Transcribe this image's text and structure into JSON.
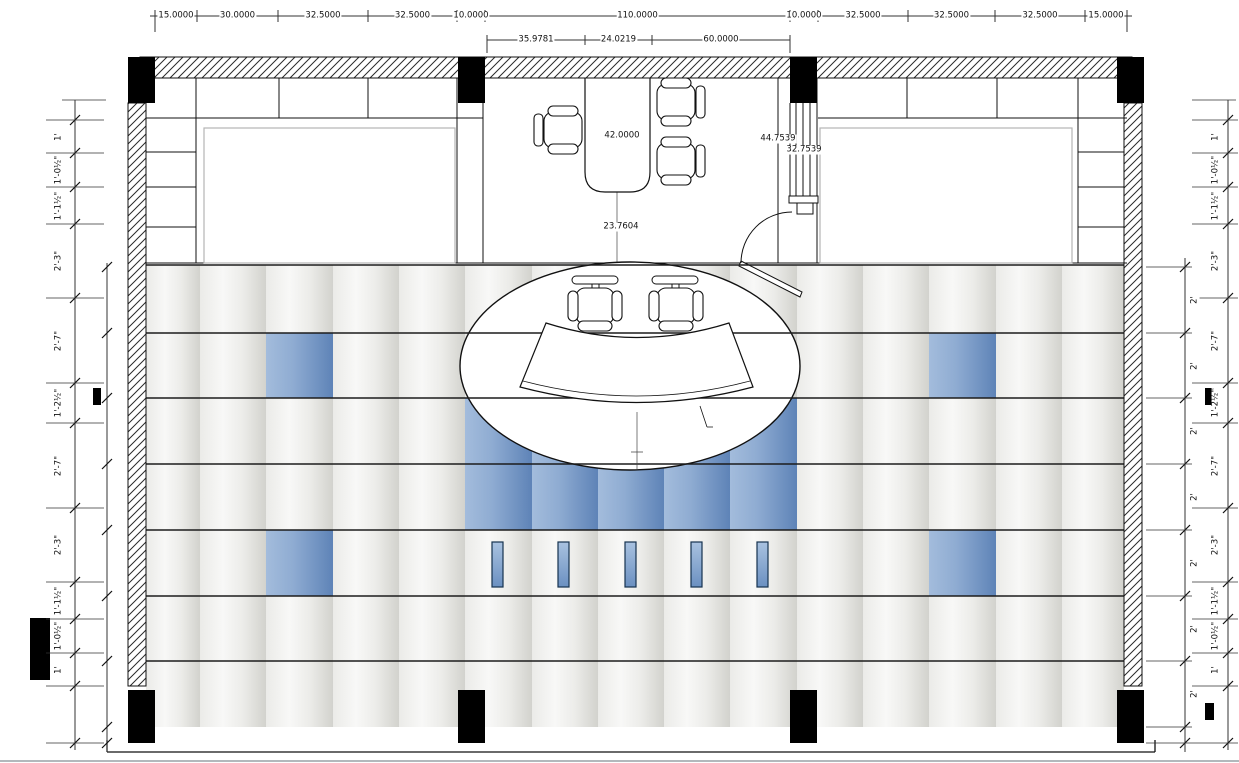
{
  "drawing": {
    "title": "office-floor-plan",
    "colors": {
      "tile_blue": "#7b9cc9",
      "tile_gray": "#e6e6e2",
      "line": "#111111"
    },
    "dimensions": {
      "top": [
        "15.0000",
        "30.0000",
        "32.5000",
        "32.5000",
        "10.0000",
        "110.0000",
        "10.0000",
        "32.5000",
        "32.5000",
        "32.5000",
        "15.0000"
      ],
      "top_inner": [
        "35.9781",
        "24.0219",
        "60.0000"
      ],
      "left": [
        "1'",
        "1'-0½\"",
        "1'-1½\"",
        "2'-3\"",
        "2'-7\"",
        "1'-2½\"",
        "2'-7\"",
        "2'-3\"",
        "1'-1½\"",
        "1'-0½\"",
        "1'"
      ],
      "right_outer": [
        "1'",
        "1'-0½\"",
        "1'-1½\"",
        "2'-3\"",
        "2'-7\"",
        "1'-2½\"",
        "2'-7\"",
        "2'-3\"",
        "1'-1½\"",
        "1'-0½\"",
        "1'"
      ],
      "right_inner": [
        "2'",
        "2'",
        "2'",
        "2'",
        "2'",
        "2'",
        "2'"
      ]
    },
    "annotations": {
      "desk_width": "42.0000",
      "desk_clearance": "23.7604",
      "door_dim_a": "44.7539",
      "door_dim_b": "32.7539"
    }
  }
}
